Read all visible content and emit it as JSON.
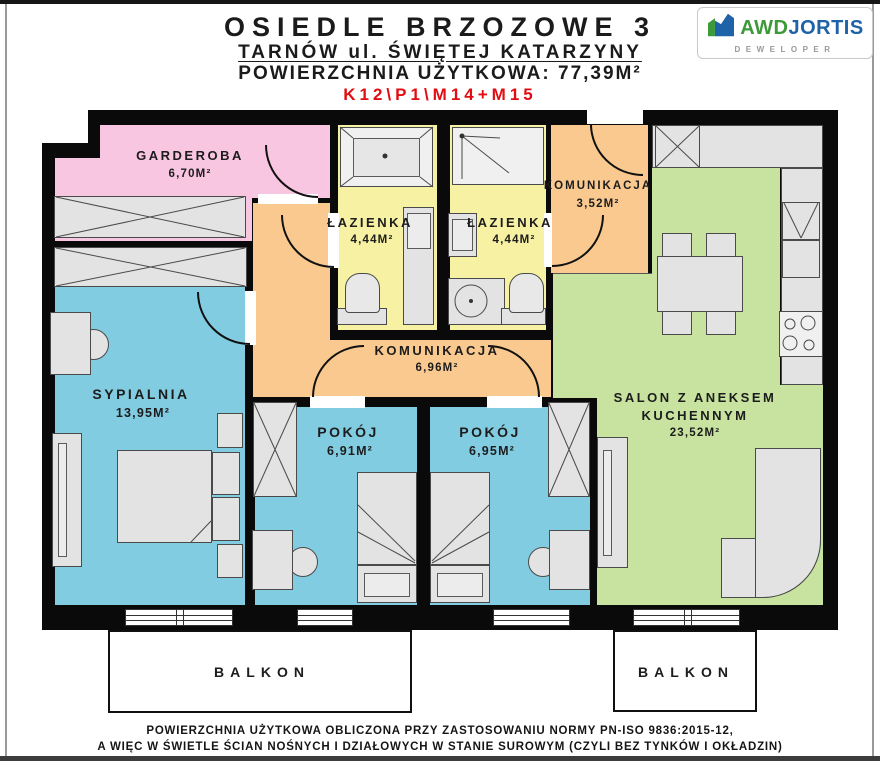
{
  "header": {
    "title": "OSIEDLE BRZOZOWE 3",
    "subtitle": "TARNÓW ul. ŚWIĘTEJ KATARZYNY",
    "area_line": "POWIERZCHNIA UŻYTKOWA: 77,39M²",
    "unit_code": "K12\\P1\\M14+M15",
    "unit_code_color": "#e20d12"
  },
  "logo": {
    "brand_part1": "AWD",
    "brand_part2": "JORTIS",
    "tagline": "DEWELOPER",
    "green": "#3d9a39",
    "blue": "#1e62a8"
  },
  "rooms": {
    "garderoba": {
      "name": "GARDEROBA",
      "area": "6,70M²",
      "color": "#f9c6e1"
    },
    "lazienka_left": {
      "name": "ŁAZIENKA",
      "area": "4,44M²",
      "color": "#f6f1a3"
    },
    "lazienka_right": {
      "name": "ŁAZIENKA",
      "area": "4,44M²",
      "color": "#f6f1a3"
    },
    "komunikacja_top": {
      "name": "KOMUNIKACJA",
      "area": "3,52M²",
      "color": "#f9c98f"
    },
    "sypialnia": {
      "name": "SYPIALNIA",
      "area": "13,95M²",
      "color": "#82cce1"
    },
    "komunikacja_mid": {
      "name": "KOMUNIKACJA",
      "area": "6,96M²",
      "color": "#f9c98f"
    },
    "pokoj_left": {
      "name": "POKÓJ",
      "area": "6,91M²",
      "color": "#82cce1"
    },
    "pokoj_right": {
      "name": "POKÓJ",
      "area": "6,95M²",
      "color": "#82cce1"
    },
    "salon": {
      "name_line1": "SALON Z ANEKSEM",
      "name_line2": "KUCHENNYM",
      "area": "23,52M²",
      "color": "#c8e39f"
    },
    "balkon_left": {
      "name": "BALKON"
    },
    "balkon_right": {
      "name": "BALKON"
    }
  },
  "colors": {
    "walls": "#0a0a0a",
    "furniture": "#e3e3e3"
  },
  "footer": {
    "line1": "POWIERZCHNIA UŻYTKOWA OBLICZONA PRZY ZASTOSOWANIU NORMY PN-ISO 9836:2015-12,",
    "line2": "A WIĘC W ŚWIETLE ŚCIAN NOŚNYCH I DZIAŁOWYCH W STANIE SUROWYM (CZYLI BEZ TYNKÓW I OKŁADZIN)"
  }
}
